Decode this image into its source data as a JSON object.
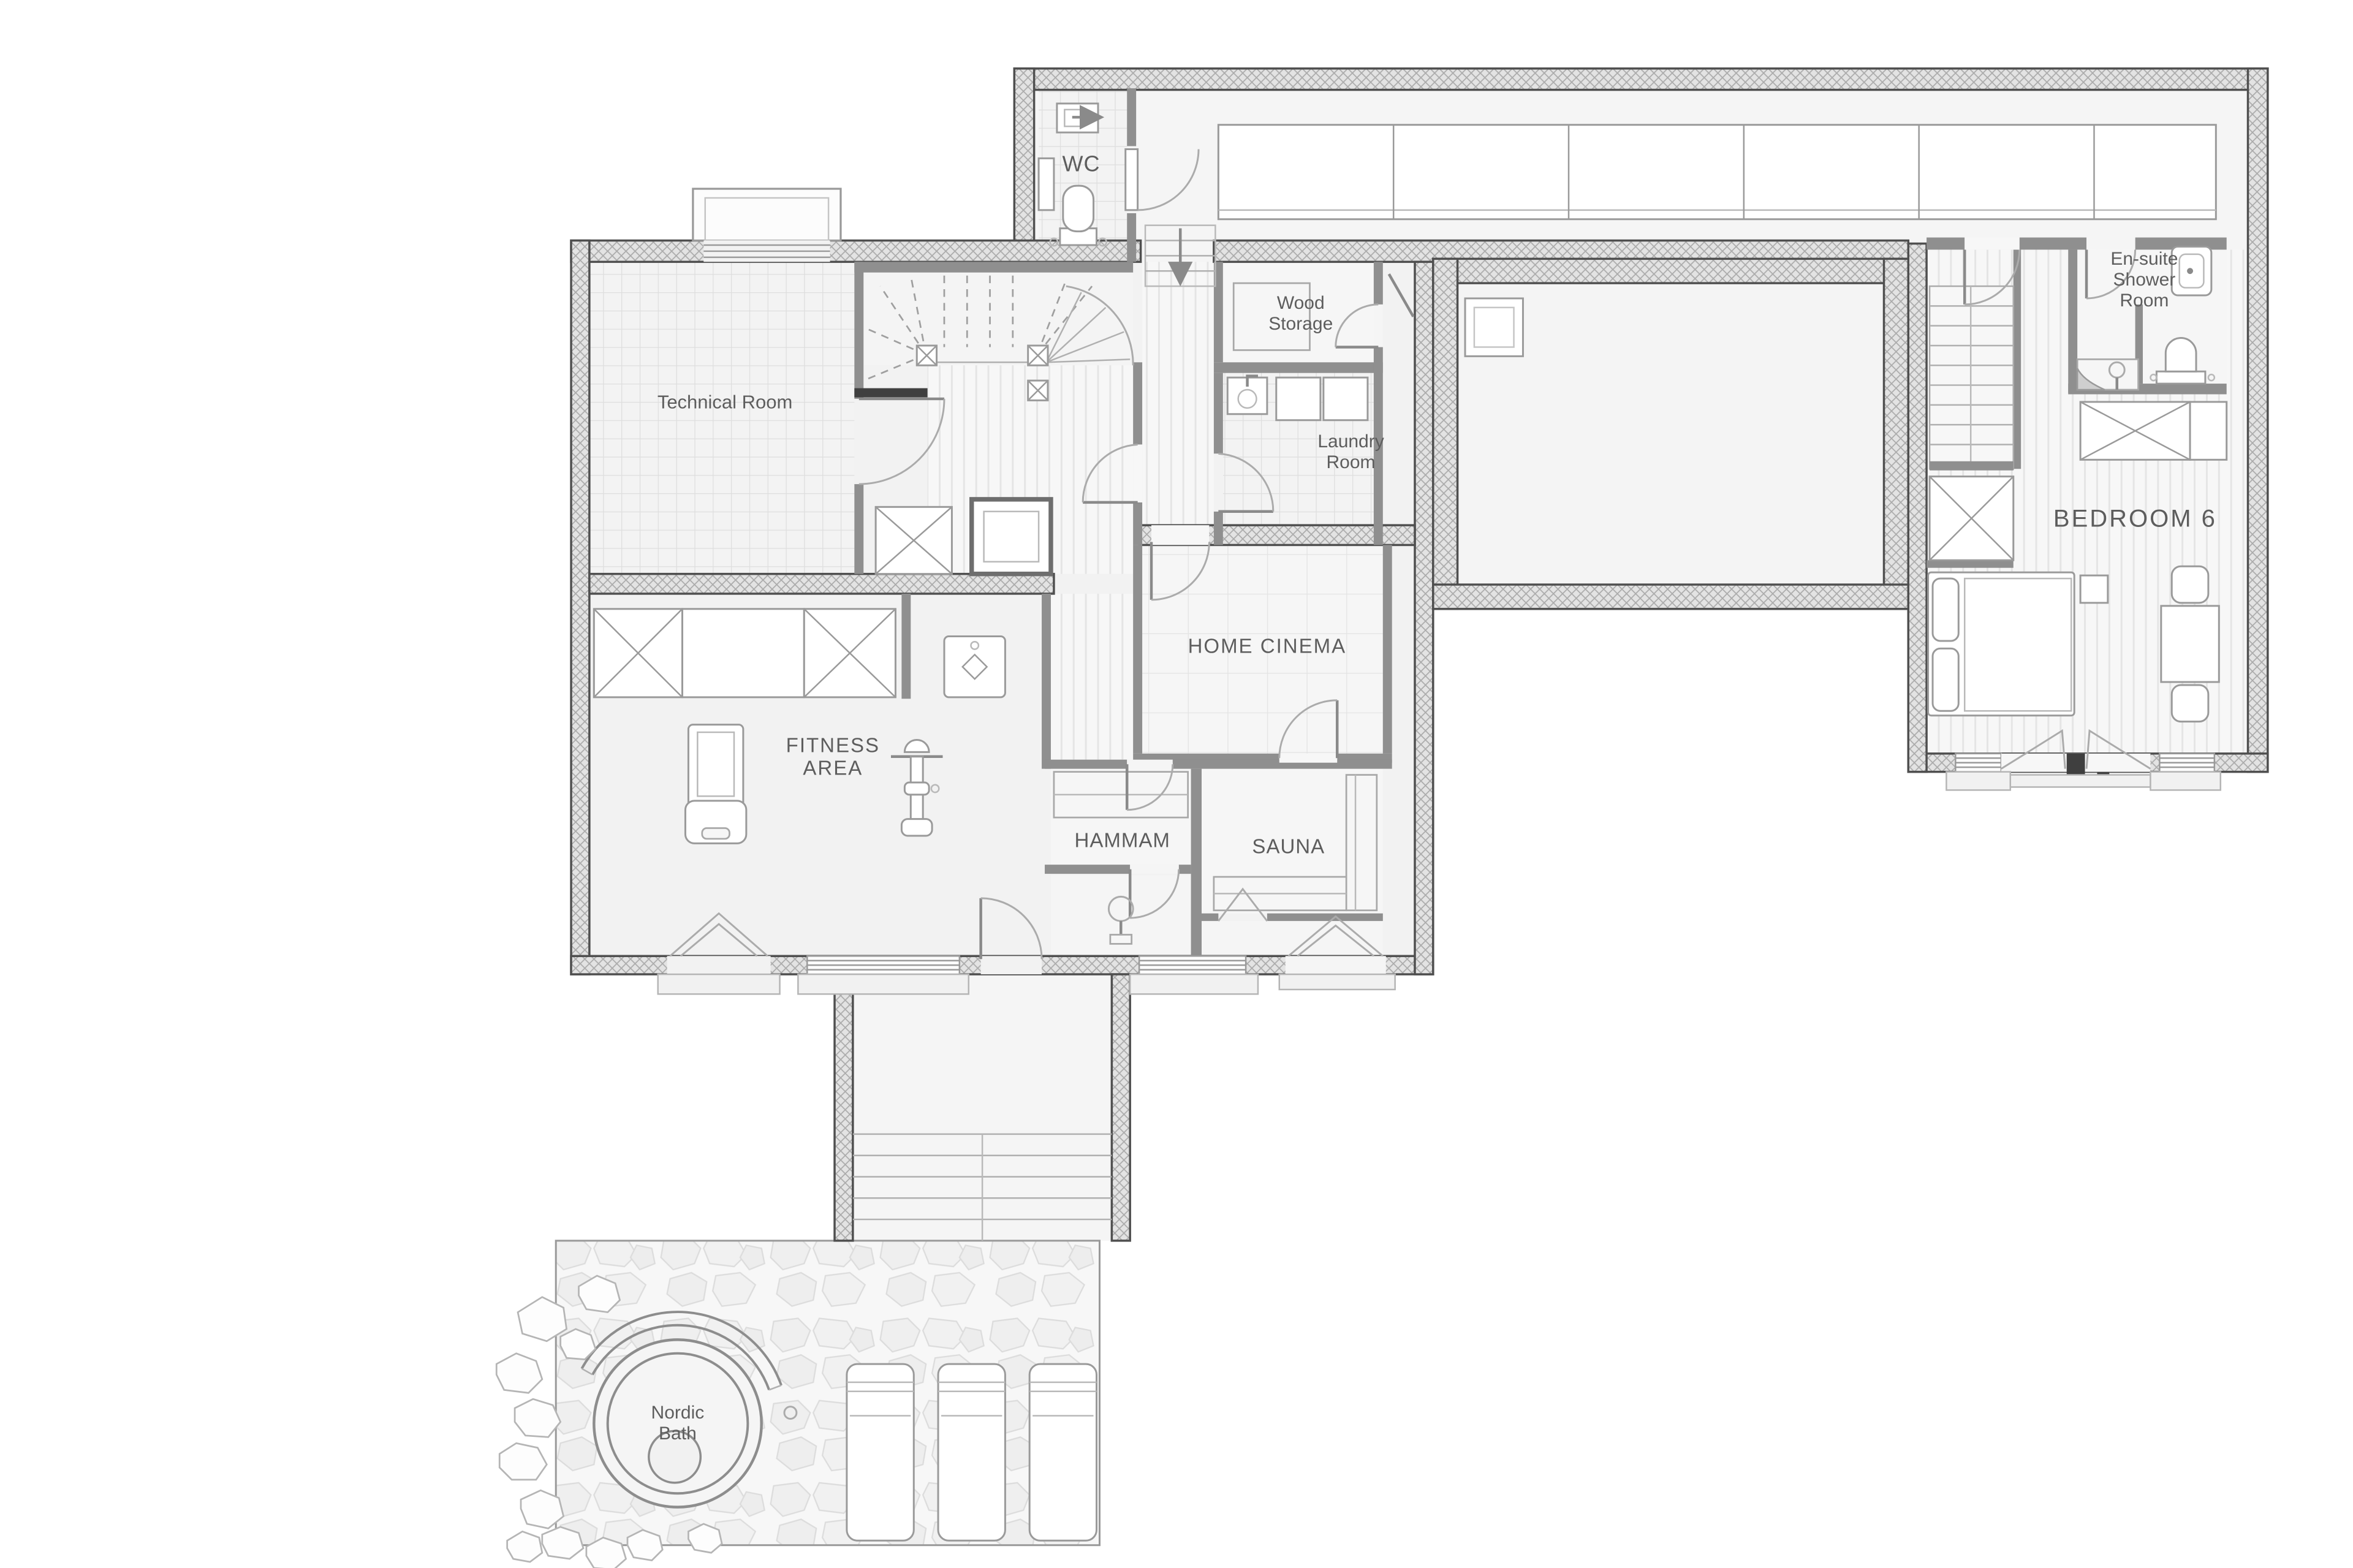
{
  "page": {
    "background": "#ffffff"
  },
  "colors": {
    "exterior_wall_fill": "#e3e3e3",
    "exterior_wall_line": "#4f4f4f",
    "partition_wall": "#8f8f8f",
    "floor_light": "#f4f4f4",
    "label_text": "#5d5d5d"
  },
  "rooms": {
    "wc": {
      "label": "WC"
    },
    "wood_storage": {
      "line1": "Wood",
      "line2": "Storage"
    },
    "laundry_room": {
      "line1": "Laundry",
      "line2": "Room"
    },
    "technical_room": {
      "label": "Technical Room"
    },
    "home_cinema": {
      "label": "HOME CINEMA"
    },
    "fitness_area": {
      "line1": "FITNESS",
      "line2": "AREA"
    },
    "hammam": {
      "label": "HAMMAM"
    },
    "sauna": {
      "label": "SAUNA"
    },
    "bedroom_6": {
      "label": "BEDROOM 6"
    },
    "ensuite_shower_room": {
      "line1": "En-suite",
      "line2": "Shower",
      "line3": "Room"
    },
    "nordic_bath": {
      "line1": "Nordic",
      "line2": "Bath"
    }
  }
}
